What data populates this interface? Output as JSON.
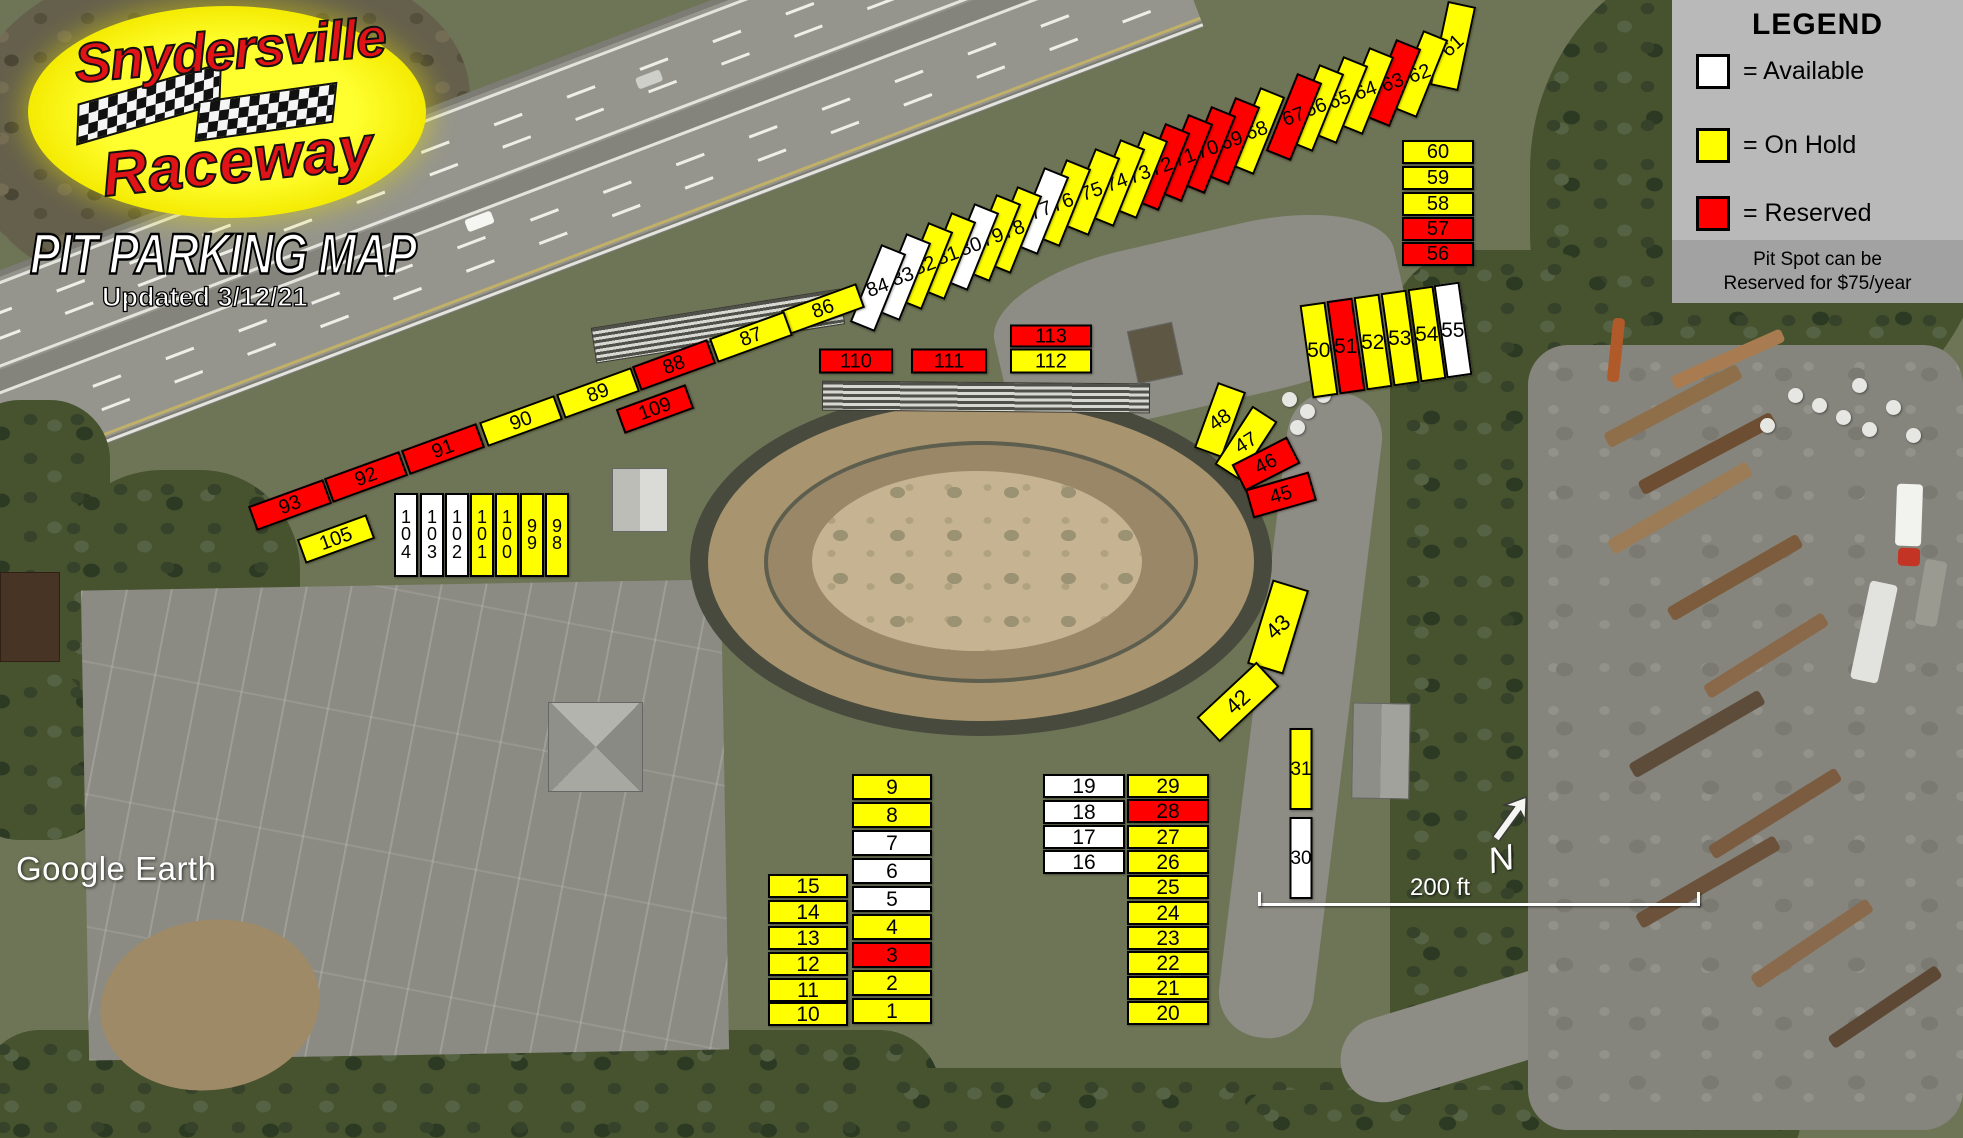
{
  "logo": {
    "name_top": "Snydersville",
    "name_bottom": "Raceway",
    "title": "PIT PARKING MAP",
    "updated": "Updated 3/12/21"
  },
  "legend": {
    "title": "LEGEND",
    "items": [
      {
        "key": "available",
        "label": "= Available"
      },
      {
        "key": "hold",
        "label": "= On Hold"
      },
      {
        "key": "reserved",
        "label": "= Reserved"
      }
    ],
    "note_line1": "Pit Spot can be",
    "note_line2": "Reserved for $75/year"
  },
  "colors": {
    "available": "#ffffff",
    "hold": "#ffff00",
    "reserved": "#ff0000"
  },
  "footer": {
    "attribution": "Google Earth",
    "scale_label": "200 ft",
    "north_label": "N"
  },
  "spots": [
    {
      "n": "61",
      "x": 1453,
      "y": 46,
      "w": 29,
      "h": 86,
      "r": 12,
      "t": -55,
      "s": "hold"
    },
    {
      "n": "62",
      "x": 1420,
      "y": 74,
      "w": 27,
      "h": 84,
      "r": 22,
      "t": -42,
      "s": "hold"
    },
    {
      "n": "63",
      "x": 1393,
      "y": 83,
      "w": 27,
      "h": 84,
      "r": 22,
      "t": -42,
      "s": "reserved"
    },
    {
      "n": "64",
      "x": 1366,
      "y": 91,
      "w": 27,
      "h": 84,
      "r": 22,
      "t": -42,
      "s": "hold"
    },
    {
      "n": "65",
      "x": 1340,
      "y": 100,
      "w": 27,
      "h": 84,
      "r": 22,
      "t": -42,
      "s": "hold"
    },
    {
      "n": "66",
      "x": 1316,
      "y": 108,
      "w": 27,
      "h": 84,
      "r": 22,
      "t": -42,
      "s": "hold"
    },
    {
      "n": "67",
      "x": 1294,
      "y": 117,
      "w": 27,
      "h": 84,
      "r": 22,
      "t": -42,
      "s": "reserved"
    },
    {
      "n": "68",
      "x": 1257,
      "y": 131,
      "w": 27,
      "h": 84,
      "r": 22,
      "t": -42,
      "s": "hold"
    },
    {
      "n": "69",
      "x": 1232,
      "y": 141,
      "w": 27,
      "h": 84,
      "r": 22,
      "t": -42,
      "s": "reserved"
    },
    {
      "n": "70",
      "x": 1208,
      "y": 150,
      "w": 27,
      "h": 84,
      "r": 22,
      "t": -42,
      "s": "reserved"
    },
    {
      "n": "71",
      "x": 1185,
      "y": 158,
      "w": 27,
      "h": 84,
      "r": 22,
      "t": -42,
      "s": "reserved"
    },
    {
      "n": "72",
      "x": 1162,
      "y": 167,
      "w": 27,
      "h": 84,
      "r": 22,
      "t": -42,
      "s": "reserved"
    },
    {
      "n": "73",
      "x": 1140,
      "y": 175,
      "w": 27,
      "h": 84,
      "r": 22,
      "t": -42,
      "s": "hold"
    },
    {
      "n": "74",
      "x": 1117,
      "y": 183,
      "w": 27,
      "h": 84,
      "r": 22,
      "t": -42,
      "s": "hold"
    },
    {
      "n": "75",
      "x": 1092,
      "y": 192,
      "w": 27,
      "h": 84,
      "r": 22,
      "t": -42,
      "s": "hold"
    },
    {
      "n": "76",
      "x": 1063,
      "y": 203,
      "w": 27,
      "h": 84,
      "r": 22,
      "t": -42,
      "s": "hold"
    },
    {
      "n": "77",
      "x": 1041,
      "y": 211,
      "w": 27,
      "h": 84,
      "r": 22,
      "t": -42,
      "s": "available"
    },
    {
      "n": "78",
      "x": 1014,
      "y": 230,
      "w": 27,
      "h": 84,
      "r": 22,
      "t": -42,
      "s": "hold"
    },
    {
      "n": "79",
      "x": 993,
      "y": 238,
      "w": 27,
      "h": 84,
      "r": 22,
      "t": -42,
      "s": "hold"
    },
    {
      "n": "80",
      "x": 971,
      "y": 247,
      "w": 27,
      "h": 84,
      "r": 22,
      "t": -42,
      "s": "available"
    },
    {
      "n": "81",
      "x": 948,
      "y": 256,
      "w": 27,
      "h": 84,
      "r": 22,
      "t": -42,
      "s": "hold"
    },
    {
      "n": "82",
      "x": 925,
      "y": 266,
      "w": 27,
      "h": 84,
      "r": 22,
      "t": -42,
      "s": "hold"
    },
    {
      "n": "83",
      "x": 903,
      "y": 277,
      "w": 27,
      "h": 84,
      "r": 22,
      "t": -42,
      "s": "available"
    },
    {
      "n": "84",
      "x": 878,
      "y": 288,
      "w": 27,
      "h": 84,
      "r": 22,
      "t": -42,
      "s": "available"
    },
    {
      "n": "86",
      "x": 823,
      "y": 309,
      "w": 80,
      "h": 26,
      "r": -20,
      "s": "hold"
    },
    {
      "n": "87",
      "x": 751,
      "y": 337,
      "w": 80,
      "h": 26,
      "r": -20,
      "s": "hold"
    },
    {
      "n": "88",
      "x": 674,
      "y": 365,
      "w": 80,
      "h": 26,
      "r": -20,
      "s": "reserved"
    },
    {
      "n": "89",
      "x": 598,
      "y": 393,
      "w": 80,
      "h": 26,
      "r": -20,
      "s": "hold"
    },
    {
      "n": "90",
      "x": 521,
      "y": 421,
      "w": 80,
      "h": 26,
      "r": -20,
      "s": "hold"
    },
    {
      "n": "91",
      "x": 443,
      "y": 449,
      "w": 80,
      "h": 26,
      "r": -20,
      "s": "reserved"
    },
    {
      "n": "92",
      "x": 366,
      "y": 477,
      "w": 80,
      "h": 26,
      "r": -20,
      "s": "reserved"
    },
    {
      "n": "93",
      "x": 290,
      "y": 505,
      "w": 80,
      "h": 26,
      "r": -20,
      "s": "reserved"
    },
    {
      "n": "109",
      "x": 655,
      "y": 409,
      "w": 74,
      "h": 26,
      "r": -20,
      "s": "reserved"
    },
    {
      "n": "105",
      "x": 336,
      "y": 539,
      "w": 74,
      "h": 26,
      "r": -20,
      "s": "hold"
    },
    {
      "n": "110",
      "x": 856,
      "y": 361,
      "w": 74,
      "h": 25,
      "s": "reserved"
    },
    {
      "n": "111",
      "x": 949,
      "y": 361,
      "w": 76,
      "h": 25,
      "s": "reserved"
    },
    {
      "n": "113",
      "x": 1051,
      "y": 336,
      "w": 82,
      "h": 23,
      "s": "reserved"
    },
    {
      "n": "112",
      "x": 1051,
      "y": 361,
      "w": 82,
      "h": 25,
      "s": "hold"
    },
    {
      "n": "104",
      "x": 406,
      "y": 535,
      "w": 24,
      "h": 84,
      "st": true,
      "fs": 18,
      "s": "available"
    },
    {
      "n": "103",
      "x": 432,
      "y": 535,
      "w": 24,
      "h": 84,
      "st": true,
      "fs": 18,
      "s": "available"
    },
    {
      "n": "102",
      "x": 457,
      "y": 535,
      "w": 24,
      "h": 84,
      "st": true,
      "fs": 18,
      "s": "available"
    },
    {
      "n": "101",
      "x": 482,
      "y": 535,
      "w": 24,
      "h": 84,
      "st": true,
      "fs": 18,
      "s": "hold"
    },
    {
      "n": "100",
      "x": 507,
      "y": 535,
      "w": 24,
      "h": 84,
      "st": true,
      "fs": 18,
      "s": "hold"
    },
    {
      "n": "99",
      "x": 532,
      "y": 535,
      "w": 24,
      "h": 84,
      "st": true,
      "fs": 18,
      "s": "hold"
    },
    {
      "n": "98",
      "x": 557,
      "y": 535,
      "w": 24,
      "h": 84,
      "st": true,
      "fs": 18,
      "s": "hold"
    },
    {
      "n": "48",
      "x": 1220,
      "y": 420,
      "w": 30,
      "h": 70,
      "r": 20,
      "t": -55,
      "s": "hold"
    },
    {
      "n": "47",
      "x": 1246,
      "y": 443,
      "w": 30,
      "h": 70,
      "r": 33,
      "t": -65,
      "s": "hold"
    },
    {
      "n": "46",
      "x": 1266,
      "y": 464,
      "w": 62,
      "h": 30,
      "r": -27,
      "s": "reserved"
    },
    {
      "n": "45",
      "x": 1281,
      "y": 495,
      "w": 66,
      "h": 30,
      "r": -16,
      "s": "reserved"
    },
    {
      "n": "43",
      "x": 1278,
      "y": 627,
      "w": 38,
      "h": 88,
      "r": 17,
      "t": -60,
      "fs": 22,
      "s": "hold"
    },
    {
      "n": "42",
      "x": 1238,
      "y": 702,
      "w": 82,
      "h": 34,
      "r": -43,
      "fs": 22,
      "s": "hold"
    },
    {
      "n": "31",
      "x": 1301,
      "y": 769,
      "w": 23,
      "h": 82,
      "fs": 19,
      "s": "hold"
    },
    {
      "n": "30",
      "x": 1301,
      "y": 858,
      "w": 23,
      "h": 82,
      "fs": 19,
      "s": "available"
    },
    {
      "n": "50",
      "x": 1319,
      "y": 350,
      "w": 26,
      "h": 94,
      "r": -8,
      "t": 8,
      "fs": 21,
      "s": "hold"
    },
    {
      "n": "51",
      "x": 1346,
      "y": 346,
      "w": 26,
      "h": 94,
      "r": -8,
      "t": 8,
      "fs": 21,
      "s": "reserved"
    },
    {
      "n": "52",
      "x": 1373,
      "y": 342,
      "w": 26,
      "h": 94,
      "r": -8,
      "t": 8,
      "fs": 21,
      "s": "hold"
    },
    {
      "n": "53",
      "x": 1400,
      "y": 338,
      "w": 26,
      "h": 94,
      "r": -8,
      "t": 8,
      "fs": 21,
      "s": "hold"
    },
    {
      "n": "54",
      "x": 1427,
      "y": 334,
      "w": 26,
      "h": 94,
      "r": -8,
      "t": 8,
      "fs": 21,
      "s": "hold"
    },
    {
      "n": "55",
      "x": 1453,
      "y": 330,
      "w": 26,
      "h": 94,
      "r": -8,
      "t": 8,
      "fs": 21,
      "s": "available"
    },
    {
      "n": "60",
      "x": 1438,
      "y": 152,
      "w": 72,
      "h": 24,
      "s": "hold"
    },
    {
      "n": "59",
      "x": 1438,
      "y": 178,
      "w": 72,
      "h": 24,
      "s": "hold"
    },
    {
      "n": "58",
      "x": 1438,
      "y": 204,
      "w": 72,
      "h": 24,
      "s": "hold"
    },
    {
      "n": "57",
      "x": 1438,
      "y": 229,
      "w": 72,
      "h": 24,
      "s": "reserved"
    },
    {
      "n": "56",
      "x": 1438,
      "y": 254,
      "w": 72,
      "h": 24,
      "s": "reserved"
    },
    {
      "n": "9",
      "x": 892,
      "y": 787,
      "w": 80,
      "h": 26,
      "fs": 21,
      "s": "hold"
    },
    {
      "n": "8",
      "x": 892,
      "y": 815,
      "w": 80,
      "h": 26,
      "fs": 21,
      "s": "hold"
    },
    {
      "n": "7",
      "x": 892,
      "y": 843,
      "w": 80,
      "h": 26,
      "fs": 21,
      "s": "available"
    },
    {
      "n": "6",
      "x": 892,
      "y": 871,
      "w": 80,
      "h": 26,
      "fs": 21,
      "s": "available"
    },
    {
      "n": "5",
      "x": 892,
      "y": 899,
      "w": 80,
      "h": 26,
      "fs": 21,
      "s": "available"
    },
    {
      "n": "4",
      "x": 892,
      "y": 927,
      "w": 80,
      "h": 26,
      "fs": 21,
      "s": "hold"
    },
    {
      "n": "3",
      "x": 892,
      "y": 955,
      "w": 80,
      "h": 26,
      "fs": 21,
      "s": "reserved"
    },
    {
      "n": "2",
      "x": 892,
      "y": 983,
      "w": 80,
      "h": 26,
      "fs": 21,
      "s": "hold"
    },
    {
      "n": "1",
      "x": 892,
      "y": 1011,
      "w": 80,
      "h": 26,
      "fs": 21,
      "s": "hold"
    },
    {
      "n": "15",
      "x": 808,
      "y": 886,
      "w": 80,
      "h": 24,
      "fs": 21,
      "s": "hold"
    },
    {
      "n": "14",
      "x": 808,
      "y": 912,
      "w": 80,
      "h": 24,
      "fs": 21,
      "s": "hold"
    },
    {
      "n": "13",
      "x": 808,
      "y": 938,
      "w": 80,
      "h": 24,
      "fs": 21,
      "s": "hold"
    },
    {
      "n": "12",
      "x": 808,
      "y": 964,
      "w": 80,
      "h": 24,
      "fs": 21,
      "s": "hold"
    },
    {
      "n": "11",
      "x": 808,
      "y": 990,
      "w": 80,
      "h": 24,
      "fs": 21,
      "s": "hold"
    },
    {
      "n": "10",
      "x": 808,
      "y": 1014,
      "w": 80,
      "h": 24,
      "fs": 21,
      "s": "hold"
    },
    {
      "n": "19",
      "x": 1084,
      "y": 786,
      "w": 82,
      "h": 24,
      "fs": 21,
      "s": "available"
    },
    {
      "n": "18",
      "x": 1084,
      "y": 812,
      "w": 82,
      "h": 24,
      "fs": 21,
      "s": "available"
    },
    {
      "n": "17",
      "x": 1084,
      "y": 837,
      "w": 82,
      "h": 24,
      "fs": 21,
      "s": "available"
    },
    {
      "n": "16",
      "x": 1084,
      "y": 862,
      "w": 82,
      "h": 24,
      "fs": 21,
      "s": "available"
    },
    {
      "n": "29",
      "x": 1168,
      "y": 786,
      "w": 82,
      "h": 24,
      "fs": 21,
      "s": "hold"
    },
    {
      "n": "28",
      "x": 1168,
      "y": 811,
      "w": 82,
      "h": 24,
      "fs": 21,
      "s": "reserved"
    },
    {
      "n": "27",
      "x": 1168,
      "y": 837,
      "w": 82,
      "h": 24,
      "fs": 21,
      "s": "hold"
    },
    {
      "n": "26",
      "x": 1168,
      "y": 862,
      "w": 82,
      "h": 24,
      "fs": 21,
      "s": "hold"
    },
    {
      "n": "25",
      "x": 1168,
      "y": 887,
      "w": 82,
      "h": 24,
      "fs": 21,
      "s": "hold"
    },
    {
      "n": "24",
      "x": 1168,
      "y": 913,
      "w": 82,
      "h": 24,
      "fs": 21,
      "s": "hold"
    },
    {
      "n": "23",
      "x": 1168,
      "y": 938,
      "w": 82,
      "h": 24,
      "fs": 21,
      "s": "hold"
    },
    {
      "n": "22",
      "x": 1168,
      "y": 963,
      "w": 82,
      "h": 24,
      "fs": 21,
      "s": "hold"
    },
    {
      "n": "21",
      "x": 1168,
      "y": 988,
      "w": 82,
      "h": 24,
      "fs": 21,
      "s": "hold"
    },
    {
      "n": "20",
      "x": 1168,
      "y": 1013,
      "w": 82,
      "h": 24,
      "fs": 21,
      "s": "hold"
    }
  ]
}
